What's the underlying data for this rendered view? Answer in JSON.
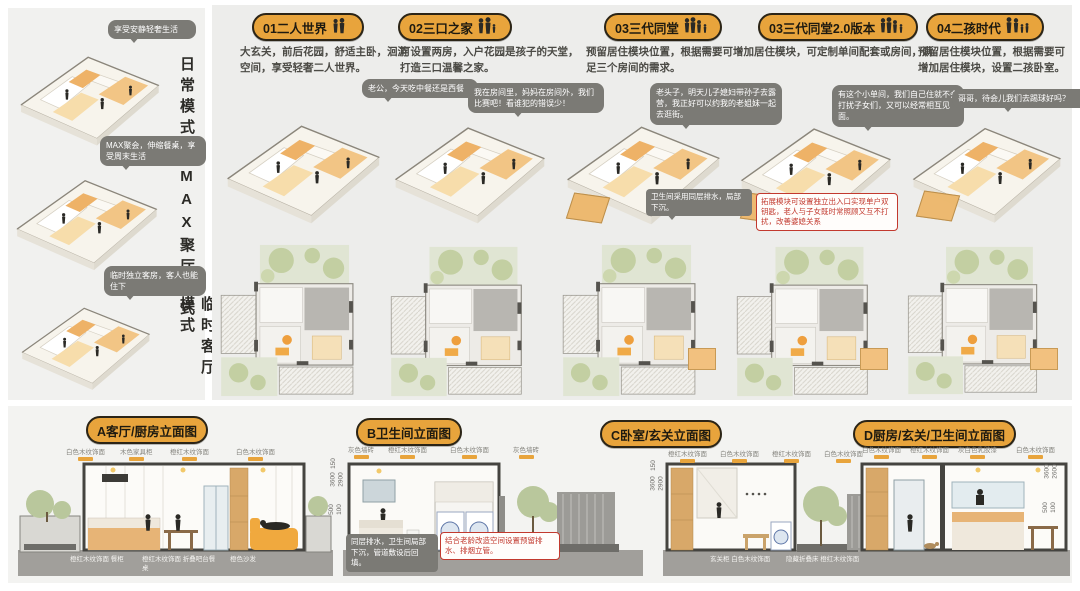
{
  "left_panel": {
    "modes": [
      {
        "label": "日常模式",
        "bubble": "享受安静轻奢生活"
      },
      {
        "label": "MAX聚厅模式",
        "bubble": "MAX聚会，伸缩餐桌，享受周末生活"
      },
      {
        "label": "临时客厅模式",
        "bubble": "临时独立客房，客人也能住下"
      }
    ]
  },
  "scenarios": [
    {
      "title": "01二人世界",
      "desc": "大玄关，前后花园，舒适主卧，洄游空间，享受轻奢二人世界。",
      "bubble": "老公，今天吃中餐还是西餐"
    },
    {
      "title": "02三口之家",
      "desc": "可设置两房，入户花园是孩子的天堂，打造三口温馨之家。",
      "bubble": "我在房间里，妈妈在房间外，我们比赛吧！看谁犯的错误少！"
    },
    {
      "title": "03三代同堂",
      "desc": "预留居住模块位置，根据需要可增加居住模块，可定制单间配套或房间，满足三个房间的需求。",
      "bubble": "老头子，明天儿子媳妇带孙子去露营，我正好可以约我的老姐妹一起去逛街。",
      "note": "卫生间采用同层排水，局部下沉。"
    },
    {
      "title": "03三代同堂2.0版本",
      "bubble": "有这个小单间，我们自己住就不会打扰子女们，又可以经常相互见面。",
      "red_note": "拓展模块可设置独立出入口实现单户双钥匙，老人与子女既时常照顾又互不打扰，改善婆媳关系"
    },
    {
      "title": "04二孩时代",
      "desc": "预留居住模块位置，根据需要可增加居住模块，设置二孩卧室。",
      "bubble": "哥哥，待会儿我们去踢球好吗？"
    }
  ],
  "elevations": [
    {
      "title": "A客厅/厨房立面图",
      "top_labels": [
        "白色木纹饰面",
        "木色家具柜",
        "橙红木纹饰面",
        "白色木纹饰面"
      ],
      "bottom_labels": [
        "橙红木纹饰面 餐柜",
        "橙红木纹饰面 折叠吧台餐桌",
        "橙色沙发"
      ],
      "dims": [
        "150",
        "3600",
        "2900",
        "500",
        "100"
      ]
    },
    {
      "title": "B卫生间立面图",
      "top_labels": [
        "灰色墙砖",
        "橙红木纹饰面",
        "白色木纹饰面",
        "灰色墙砖"
      ],
      "notes": {
        "grey": "同层排水，卫生间局部下沉，管道敷设后回填。",
        "red": "结合老龄改造空间设置预留排水、排烟立管。"
      },
      "dims": [
        "150",
        "3600",
        "2900"
      ]
    },
    {
      "title": "C卧室/玄关立面图",
      "top_labels": [
        "橙红木纹饰面",
        "白色木纹饰面",
        "橙红木纹饰面",
        "白色木纹饰面"
      ],
      "bottom_labels": [
        "玄关柜 白色木纹饰面",
        "隐藏折叠床 橙红木纹饰面"
      ],
      "dims": []
    },
    {
      "title": "D厨房/玄关/卫生间立面图",
      "top_labels": [
        "白色木纹饰面",
        "橙红木纹饰面",
        "灰白色乳胶漆",
        "白色木纹饰面"
      ],
      "dims": [
        "3600",
        "2600",
        "500",
        "100"
      ]
    }
  ],
  "icons": {
    "couple": "couple-icon",
    "family3": "family-of-three-icon",
    "generations3": "three-generations-icon",
    "generations3v2": "three-generations-2-icon",
    "twokids": "two-kids-family-icon"
  },
  "colors": {
    "accent_orange": "#E8A43C",
    "pill_border": "#2B2416",
    "bubble_grey": "#7B7A75",
    "red_note": "#C2392E",
    "panel_grey": "#EDEDEB",
    "ground_grey": "#A19F9B",
    "plant_green": "#B9C79C",
    "module_orange": "#F0A93E"
  }
}
